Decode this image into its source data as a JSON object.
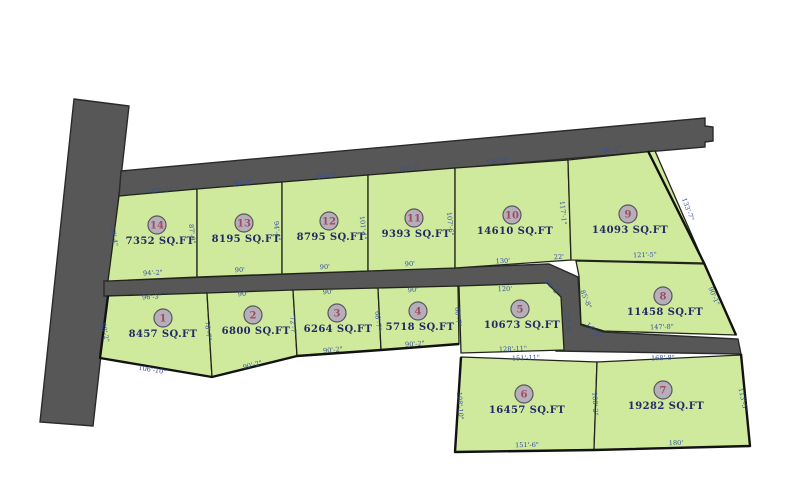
{
  "title": "subdivision-plat-map",
  "colors": {
    "background": "#ffffff",
    "lot_fill": "#cfe99d",
    "road_fill": "#575757",
    "dim_text": "#3450a0",
    "sqft_text": "#232a66",
    "badge_fill": "#b5afb9",
    "badge_stroke": "#5a5560",
    "lot_number_text": "#a34a63",
    "boundary": "#121212"
  },
  "lots": [
    {
      "num": "1",
      "sqft": "8457 SQ.FT"
    },
    {
      "num": "2",
      "sqft": "6800 SQ.FT"
    },
    {
      "num": "3",
      "sqft": "6264 SQ.FT"
    },
    {
      "num": "4",
      "sqft": "5718 SQ.FT"
    },
    {
      "num": "5",
      "sqft": "10673 SQ.FT"
    },
    {
      "num": "6",
      "sqft": "16457 SQ.FT"
    },
    {
      "num": "7",
      "sqft": "19282 SQ.FT"
    },
    {
      "num": "8",
      "sqft": "11458 SQ.FT"
    },
    {
      "num": "9",
      "sqft": "14093 SQ.FT"
    },
    {
      "num": "10",
      "sqft": "14610 SQ.FT"
    },
    {
      "num": "11",
      "sqft": "9393 SQ.FT"
    },
    {
      "num": "12",
      "sqft": "8795 SQ.FT"
    },
    {
      "num": "13",
      "sqft": "8195 SQ.FT"
    },
    {
      "num": "14",
      "sqft": "7352 SQ.FT"
    }
  ],
  "dims": [
    "107'-3\"",
    "90'-3\"",
    "90'-3\"",
    "90'-3\"",
    "130'-4\"",
    "90'-2\"",
    "58'-4\"",
    "87'-9\"",
    "94'-4\"",
    "101'-1\"",
    "107'-6\"",
    "117'-1\"",
    "133'-7\"",
    "94'-2\"",
    "90'",
    "90'",
    "90'",
    "130'",
    "22'",
    "121'-5\"",
    "96'-3\"",
    "90'",
    "90'",
    "90'",
    "120'",
    "88'-2\"",
    "78'-7\"",
    "72'-7\"",
    "68'-7\"",
    "60'-7\"",
    "72'-6\"",
    "14'-2\"",
    "14'-2\"",
    "85'-8\"",
    "90'-1\"",
    "106'-10\"",
    "90'-2\"",
    "90'-2\"",
    "90'-2\"",
    "128'-11\"",
    "151'-11\"",
    "147'-8\"",
    "168'-8\"",
    "108'-10\"",
    "108'-2\"",
    "113'-5\"",
    "151'-6\"",
    "180'"
  ]
}
